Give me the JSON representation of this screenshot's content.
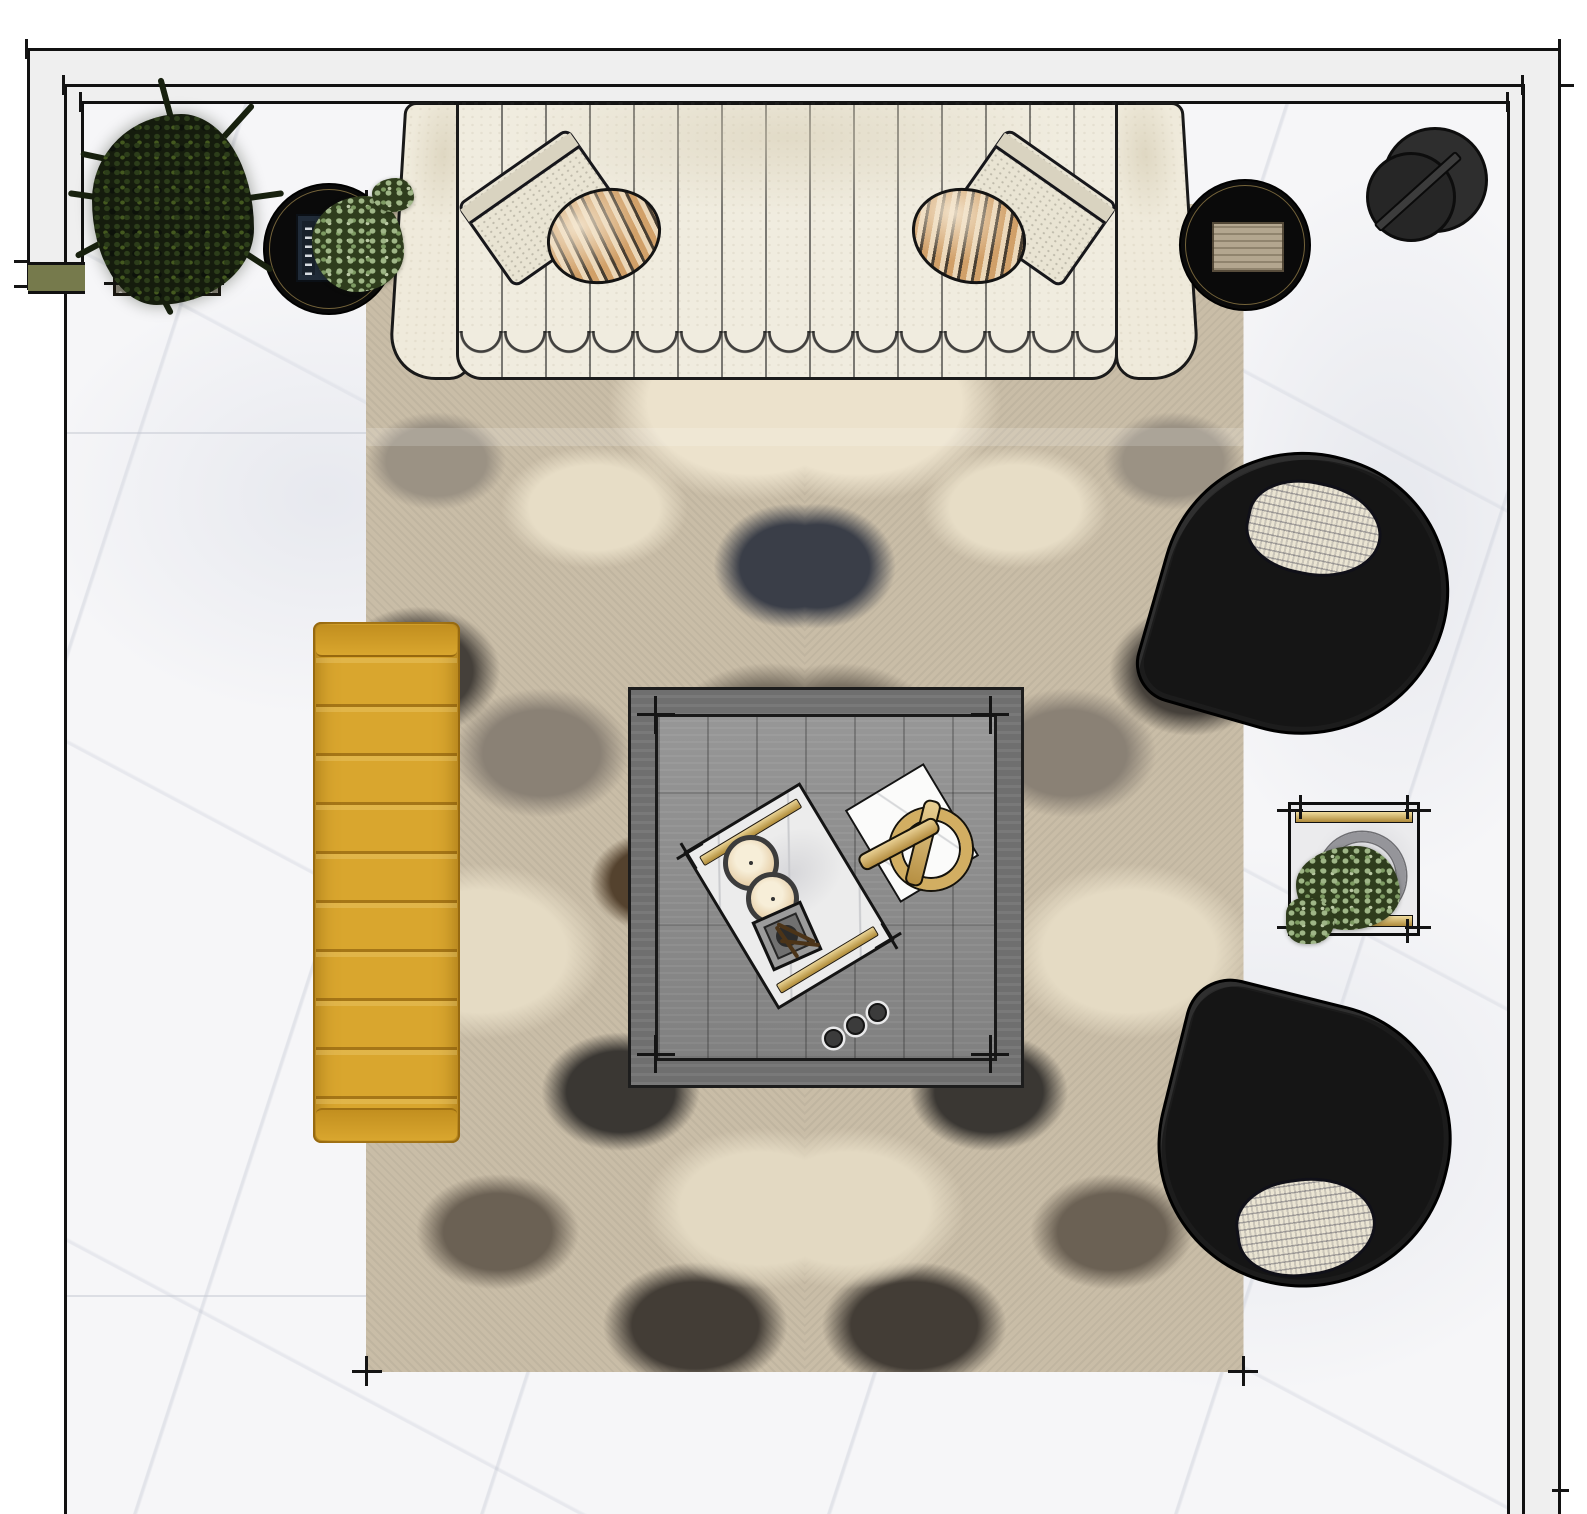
{
  "app": {
    "title": "Living room furniture plan — top view"
  },
  "palette": {
    "wall_line": "#111111",
    "wall_fill": "#efefef",
    "floor_marble": "#f6f6f8",
    "door_olive": "#767a4c",
    "rug_base": "#c9bda7",
    "rug_dark": "#3b3a40",
    "rug_brown": "#54422e",
    "rug_cream": "#ece2cc",
    "sofa_cream": "#f0ecdf",
    "bench_mustard": "#d9a62e",
    "coffee_table_gray": "#8f8f8f",
    "chair_black": "#151515",
    "side_table_black": "#0a0a0a",
    "brass_gold": "#d2ae62",
    "plant_dark_green": "#2c3d1a",
    "plant_sage": "#9fb687"
  },
  "items": {
    "walls": {
      "label": "Wall outline with offset lines"
    },
    "floor": {
      "label": "White marble floor"
    },
    "door_marker": {
      "label": "Olive wall opening marker"
    },
    "rug": {
      "label": "Abstract charcoal and taupe area rug"
    },
    "sofa": {
      "label": "Cream channel-tufted sofa"
    },
    "sofa_pillow_left_square": {
      "label": "Bone square pillow"
    },
    "sofa_pillow_left_round": {
      "label": "Tan striped round pillow"
    },
    "sofa_pillow_right_square": {
      "label": "Bone square pillow"
    },
    "sofa_pillow_right_round": {
      "label": "Tan striped round pillow"
    },
    "bench": {
      "label": "Mustard channel-tufted bench"
    },
    "coffee_table": {
      "label": "Gray wood square coffee table"
    },
    "tray": {
      "label": "Marble tray with brass rails"
    },
    "candle_large": {
      "label": "Pillar candle"
    },
    "candle_small": {
      "label": "Pillar candle"
    },
    "matchbox": {
      "label": "Match striker box"
    },
    "knot_object": {
      "label": "Brass knot sculpture on book"
    },
    "beads": {
      "label": "Decorative bead strand"
    },
    "side_table_left": {
      "label": "Black round side table with books and plant"
    },
    "side_table_right": {
      "label": "Black round side table with wood tray"
    },
    "floor_lamp": {
      "label": "Charcoal floor lamp"
    },
    "armchair_top": {
      "label": "Black curved swivel armchair"
    },
    "armchair_bottom": {
      "label": "Black curved swivel armchair"
    },
    "chair_pillow_top": {
      "label": "Striped lumbar pillow"
    },
    "chair_pillow_bottom": {
      "label": "Striped lumbar pillow"
    },
    "planter_tree": {
      "label": "Potted tree in square planter"
    },
    "planter_box": {
      "label": "Square brass planter with eucalyptus"
    }
  }
}
